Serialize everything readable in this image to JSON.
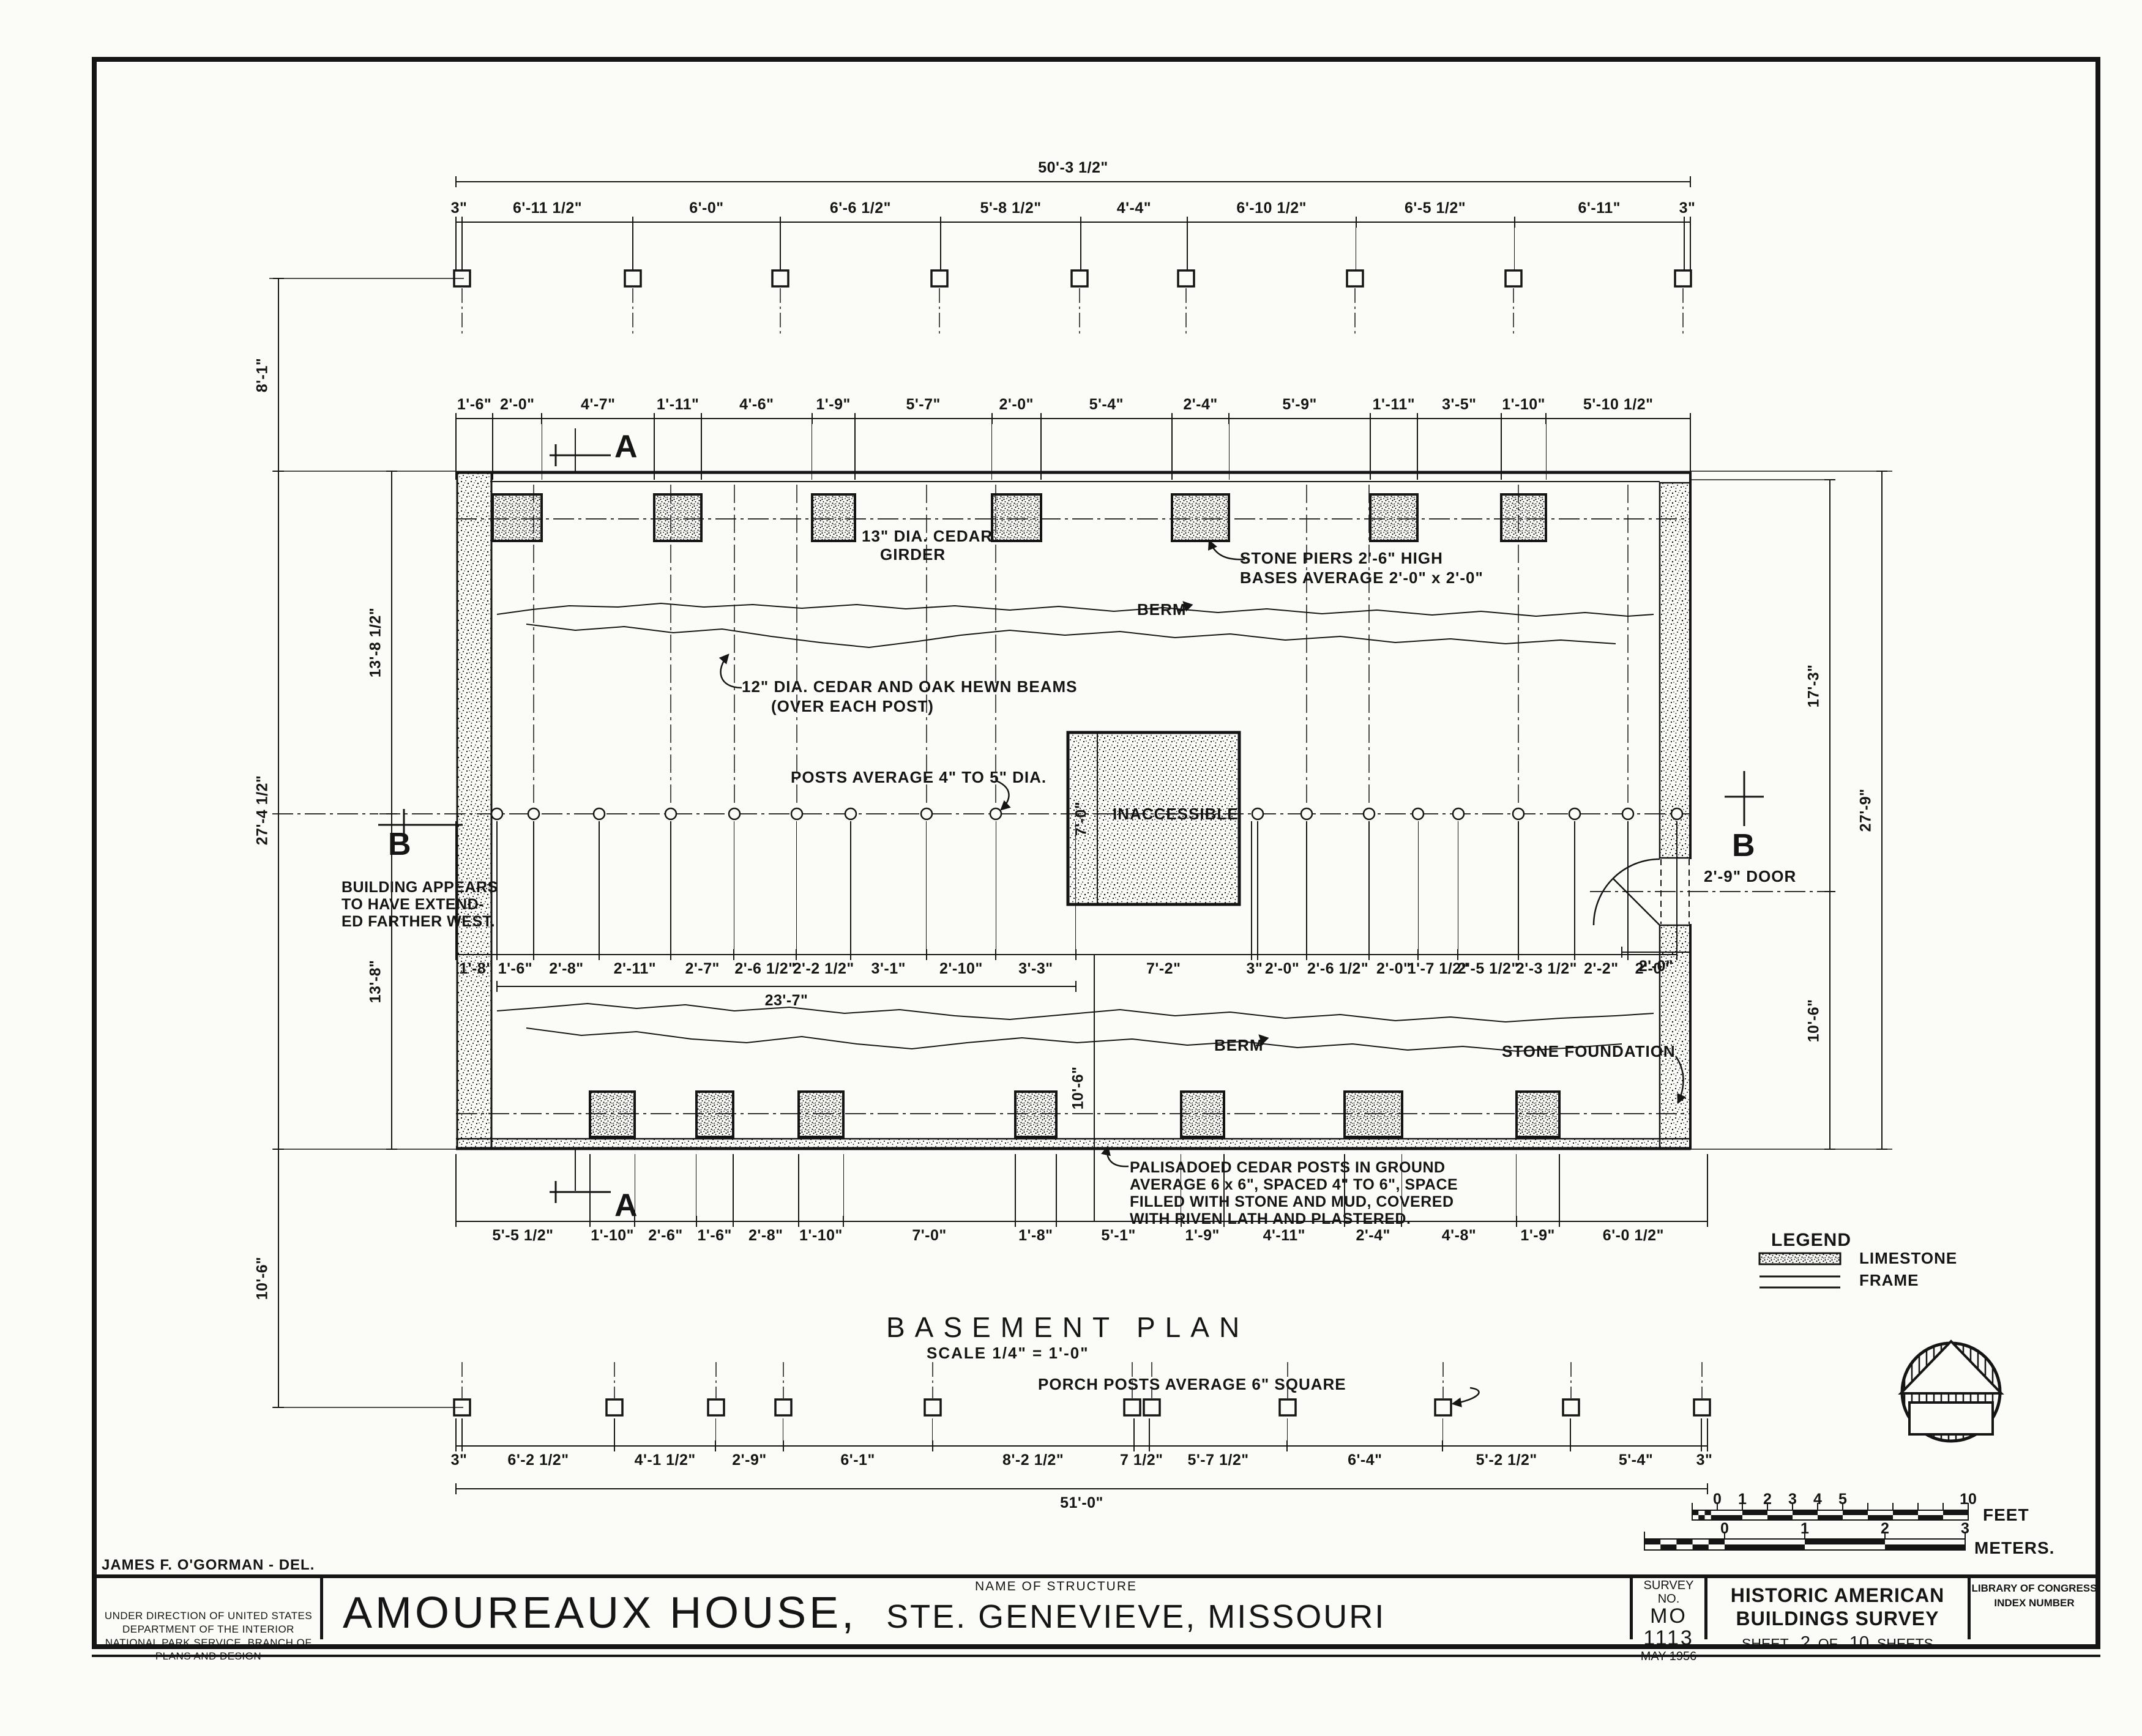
{
  "titleblock": {
    "delineator": "JAMES F. O'GORMAN - DEL.",
    "direction_line1": "UNDER DIRECTION OF UNITED STATES DEPARTMENT OF THE INTERIOR",
    "direction_line2": "NATIONAL PARK SERVICE, BRANCH OF PLANS AND DESIGN",
    "name_of_structure_label": "NAME OF STRUCTURE",
    "structure_name": "AMOUREAUX  HOUSE,",
    "structure_location": "STE.  GENEVIEVE,  MISSOURI",
    "survey_no_label": "SURVEY NO.",
    "survey_state": "MO",
    "survey_number": "1113",
    "survey_date": "MAY 1956",
    "habs_line1": "HISTORIC AMERICAN",
    "habs_line2": "BUILDINGS SURVEY",
    "sheet_label": "SHEET",
    "sheet_number": "2",
    "sheet_of": "OF",
    "sheet_total": "10",
    "sheet_sheets": "SHEETS",
    "loc_line1": "LIBRARY OF CONGRESS",
    "loc_line2": "INDEX NUMBER"
  },
  "title": {
    "main": "BASEMENT   PLAN",
    "scale": "SCALE  1/4\" = 1'-0\""
  },
  "legend": {
    "title": "LEGEND",
    "limestone": "LIMESTONE",
    "frame": "FRAME"
  },
  "scalebars": {
    "feet_ticks": [
      "0",
      "1",
      "2",
      "3",
      "4",
      "5",
      "10"
    ],
    "feet_label": "FEET",
    "meters_ticks": [
      "0",
      "1",
      "2",
      "3"
    ],
    "meters_label": "METERS."
  },
  "annotations": {
    "girder_top": [
      "13\" DIA. CEDAR",
      "GIRDER"
    ],
    "girder_bottom": "13\" DIA. CEDAR GIRDER",
    "stone_piers": [
      "STONE PIERS 2'-6\" HIGH",
      "BASES AVERAGE 2'-0\" x 2'-0\""
    ],
    "berm": "BERM",
    "beams": [
      "12\" DIA. CEDAR AND OAK HEWN BEAMS",
      "(OVER EACH POST)"
    ],
    "posts": "POSTS AVERAGE  4\" TO 5\" DIA.",
    "inaccessible": "INACCESSIBLE",
    "door": "2'-9\" DOOR",
    "stone_foundation": "STONE FOUNDATION",
    "palisadoed": [
      "PALISADOED CEDAR POSTS IN GROUND",
      "AVERAGE 6 x 6\", SPACED 4\" TO 6\", SPACE",
      "FILLED WITH STONE AND MUD, COVERED",
      "WITH RIVEN LATH AND PLASTERED."
    ],
    "building_west": [
      "BUILDING APPEARS",
      "TO HAVE EXTEND-",
      "ED FARTHER WEST."
    ],
    "porch_posts": "PORCH POSTS AVERAGE 6\" SQUARE",
    "section_a": "A",
    "section_b": "B"
  },
  "dims": {
    "top_overall": [
      "50'-3 1/2\""
    ],
    "top_porch": [
      "3\"",
      "6'-11 1/2\"",
      "6'-0\"",
      "6'-6 1/2\"",
      "5'-8 1/2\"",
      "4'-4\"",
      "6'-10 1/2\"",
      "6'-5 1/2\"",
      "6'-11\"",
      "3\""
    ],
    "pier_row": [
      "1'-6\"",
      "2'-0\"",
      "4'-7\"",
      "1'-11\"",
      "4'-6\"",
      "1'-9\"",
      "5'-7\"",
      "2'-0\"",
      "5'-4\"",
      "2'-4\"",
      "5'-9\"",
      "1'-11\"",
      "3'-5\"",
      "1'-10\"",
      "5'-10 1/2\""
    ],
    "post_row": [
      "1'-8\"",
      "1'-6\"",
      "2'-8\"",
      "2'-11\"",
      "2'-7\"",
      "2'-6 1/2\"",
      "2'-2 1/2\"",
      "3'-1\"",
      "2'-10\"",
      "3'-3\"",
      "7'-2\"",
      "3\"",
      "2'-0\"",
      "2'-6 1/2\"",
      "2'-0\"",
      "1'-7 1/2\"",
      "2'-5 1/2\"",
      "2'-3 1/2\"",
      "2'-2\"",
      "2'-0\""
    ],
    "mid_23_7": [
      "23'-7\""
    ],
    "door_2_0": [
      "2'-0\""
    ],
    "palisade_row": [
      "5'-5 1/2\"",
      "1'-10\"",
      "2'-6\"",
      "1'-6\"",
      "2'-8\"",
      "1'-10\"",
      "7'-0\"",
      "1'-8\"",
      "5'-1\"",
      "1'-9\"",
      "4'-11\"",
      "2'-4\"",
      "4'-8\"",
      "1'-9\"",
      "6'-0 1/2\""
    ],
    "porch_row": [
      "3\"",
      "6'-2 1/2\"",
      "4'-1 1/2\"",
      "2'-9\"",
      "6'-1\"",
      "8'-2 1/2\"",
      "7 1/2\"",
      "5'-7 1/2\"",
      "6'-4\"",
      "5'-2 1/2\"",
      "5'-4\"",
      "3\""
    ],
    "bottom_overall": [
      "51'-0\""
    ],
    "left_8_1": [
      "8'-1\""
    ],
    "left_27_4": [
      "27'-4 1/2\""
    ],
    "left_10_6": [
      "10'-6\""
    ],
    "left_13_8a": [
      "13'-8 1/2\""
    ],
    "left_13_8b": [
      "13'-8\""
    ],
    "right_17_3": [
      "17'-3\""
    ],
    "right_10_6": [
      "10'-6\""
    ],
    "right_27_9": [
      "27'-9\""
    ],
    "int_10_6": [
      "10'-6\""
    ],
    "int_7_0": [
      "7'-0\""
    ]
  }
}
